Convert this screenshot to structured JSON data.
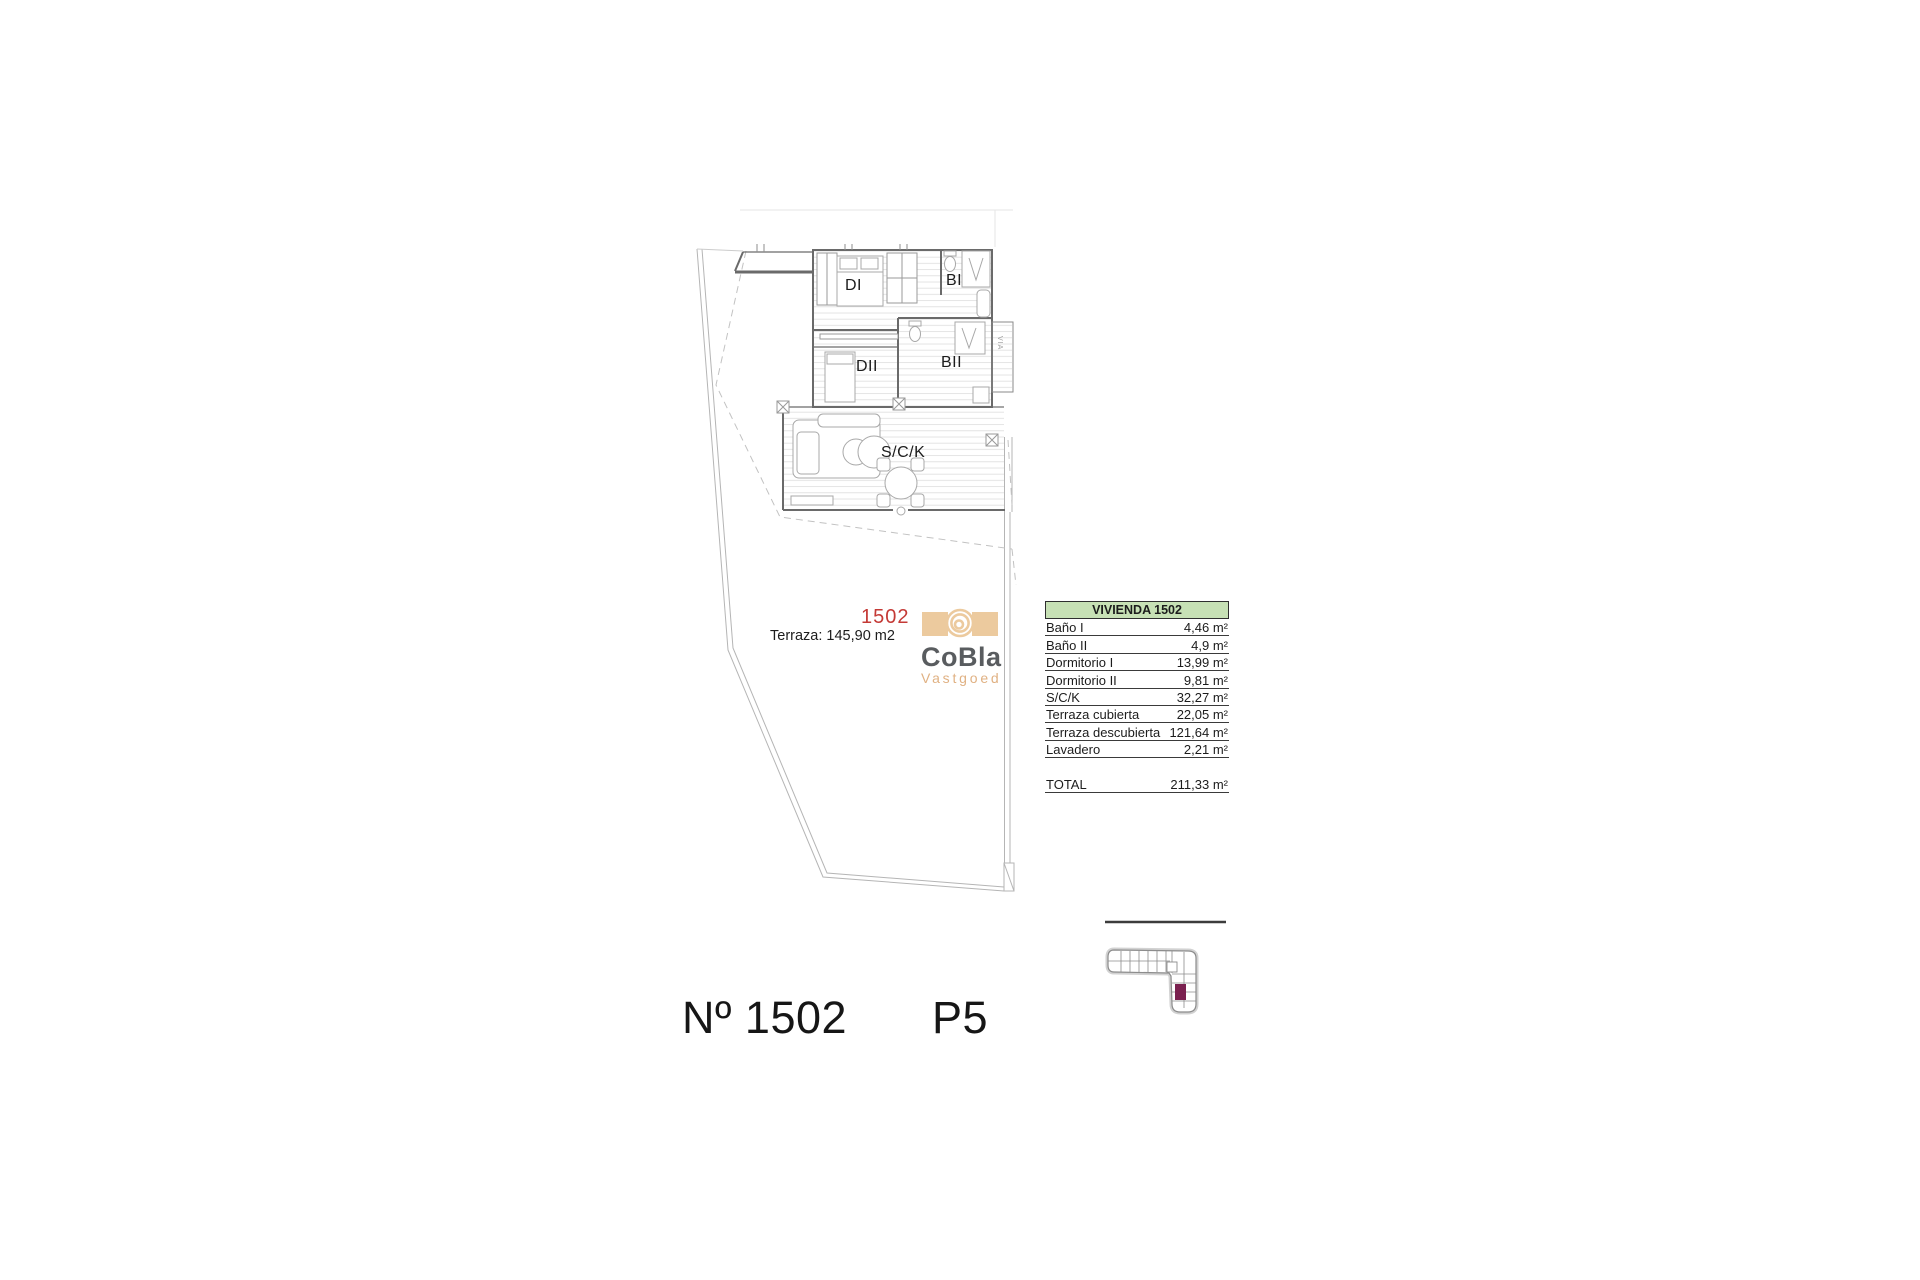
{
  "plan": {
    "unit_label": "1502",
    "terrace_label": "Terraza: 145,90 m2",
    "room_labels": {
      "dormitorio_1": "DI",
      "bano_1": "BI",
      "dormitorio_2": "DII",
      "bano_2": "BII",
      "salon": "S/C/K",
      "shaft": "VIA"
    }
  },
  "logo": {
    "title": "CoBla",
    "subtitle": "Vastgoed"
  },
  "area_table": {
    "header": "VIVIENDA 1502",
    "rows": [
      {
        "label": "Baño I",
        "value": "4,46 m²"
      },
      {
        "label": "Baño II",
        "value": "4,9 m²"
      },
      {
        "label": "Dormitorio I",
        "value": "13,99 m²"
      },
      {
        "label": "Dormitorio II",
        "value": "9,81 m²"
      },
      {
        "label": "S/C/K",
        "value": "32,27 m²"
      },
      {
        "label": "Terraza cubierta",
        "value": "22,05 m²"
      },
      {
        "label": "Terraza descubierta",
        "value": "121,64 m²"
      },
      {
        "label": "Lavadero",
        "value": "2,21 m²"
      }
    ],
    "total": {
      "label": "TOTAL",
      "value": "211,33 m²"
    }
  },
  "footer": {
    "unit_number": "Nº 1502",
    "floor": "P5"
  },
  "colors": {
    "unit_red": "#c43a36",
    "table_header_green": "#c7e1b5",
    "logo_tan": "#ecca9e",
    "logo_gray": "#595c5f",
    "keyplan_highlight": "#7b2150"
  }
}
